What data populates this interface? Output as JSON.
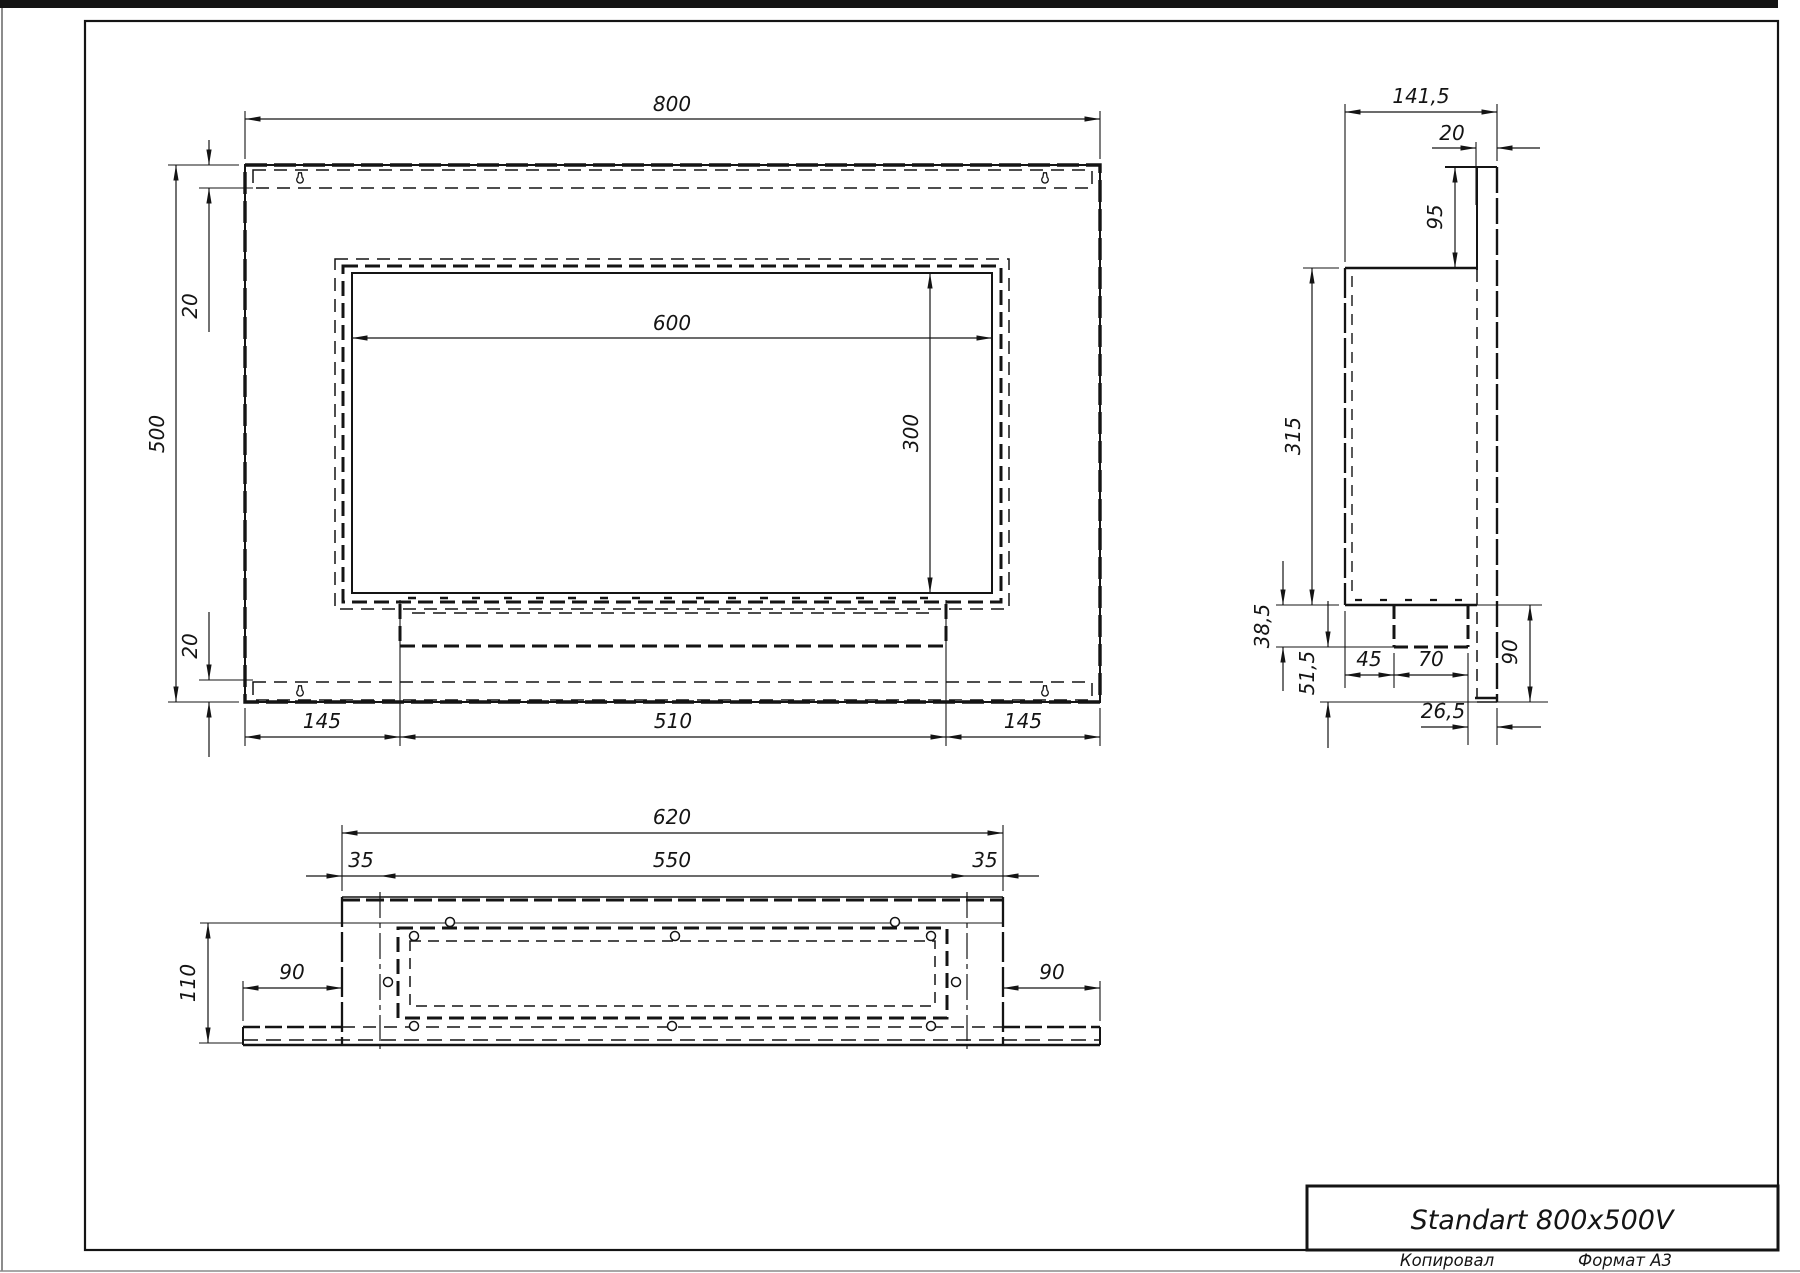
{
  "colors": {
    "line": "#141414",
    "background": "#ffffff",
    "sheet_edge": "#8a8a8a"
  },
  "title_block": {
    "title": "Standart 800x500V"
  },
  "footer": {
    "left": "Копировал",
    "right": "Формат А3"
  },
  "front_view": {
    "width": "800",
    "height": "500",
    "window_width": "600",
    "window_height": "300",
    "top_inset": "20",
    "bottom_inset": "20",
    "left_margin": "145",
    "burner_width": "510",
    "right_margin": "145"
  },
  "side_view": {
    "total_depth": "141,5",
    "plate_thickness": "20",
    "plate_above_body": "95",
    "body_height": "315",
    "burner_box_height": "38,5",
    "below_burner": "51,5",
    "front_offset": "45",
    "burner_depth": "70",
    "rear_offset": "26,5",
    "lower_height": "90"
  },
  "bottom_view": {
    "body_width": "620",
    "opening_width": "550",
    "left_inset": "35",
    "right_inset": "35",
    "body_depth": "110",
    "left_flange": "90",
    "right_flange": "90"
  }
}
